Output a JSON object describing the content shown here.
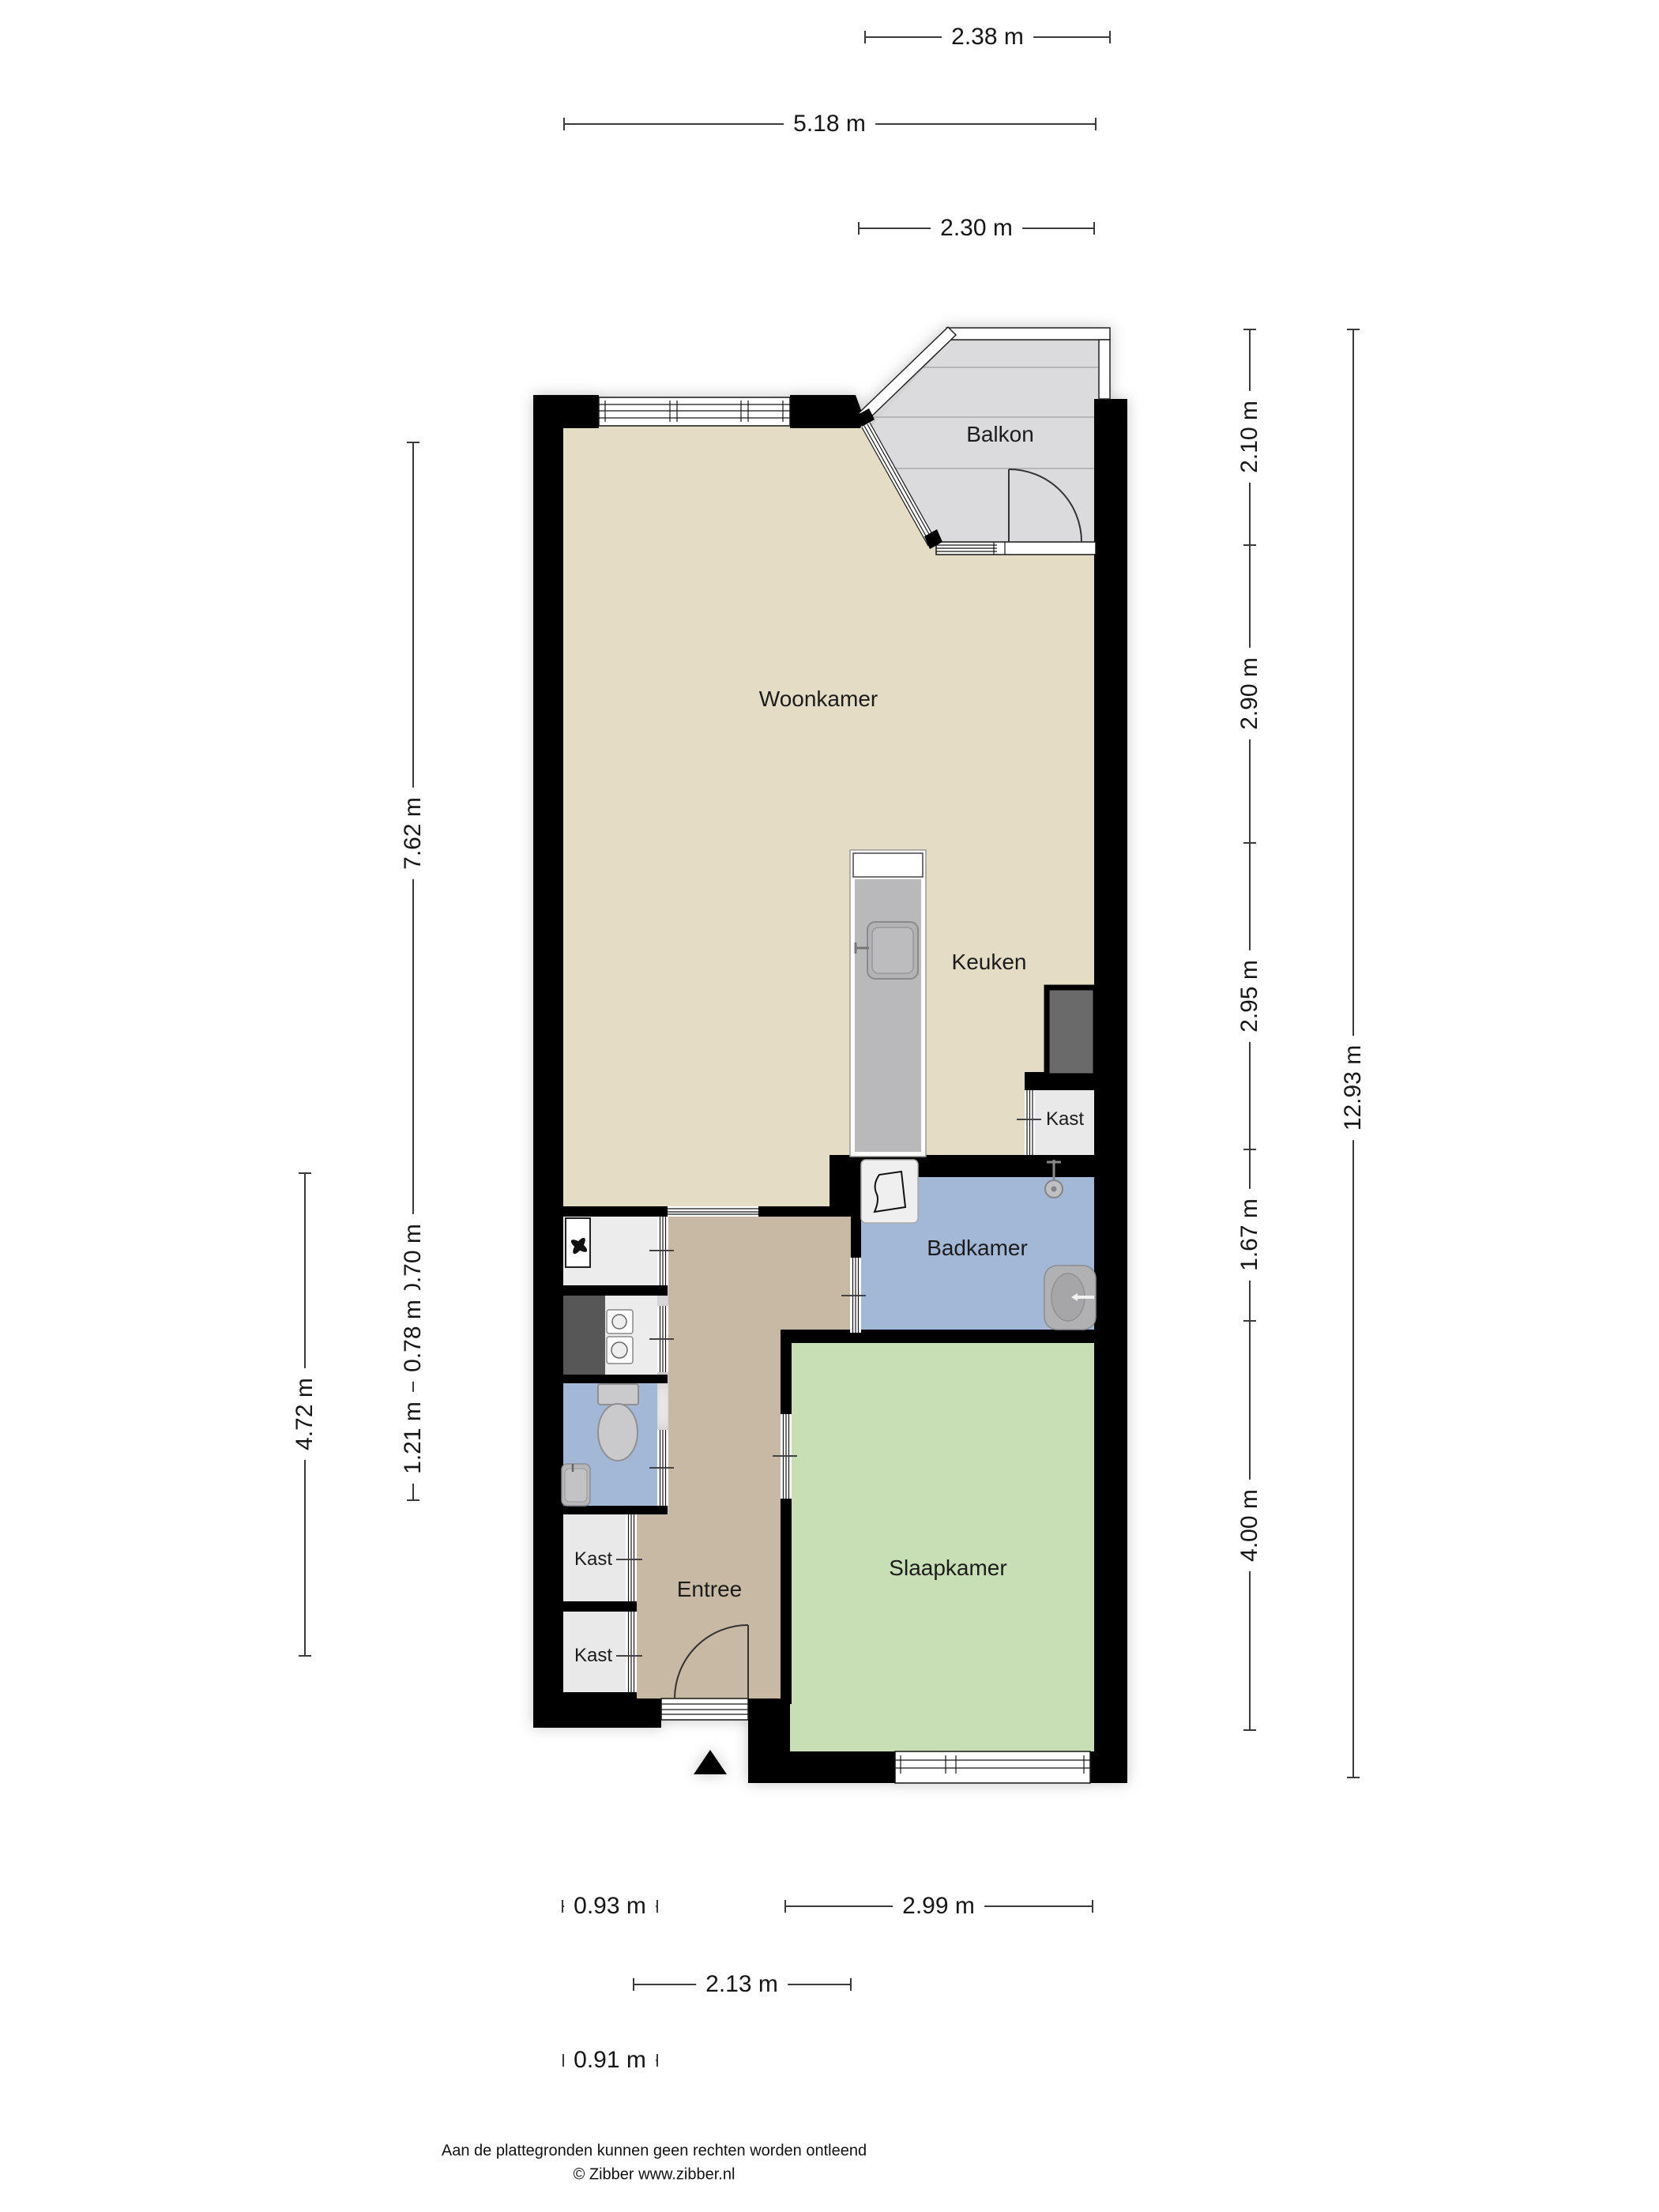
{
  "rooms": {
    "woonkamer": {
      "label": "Woonkamer"
    },
    "keuken": {
      "label": "Keuken"
    },
    "balkon": {
      "label": "Balkon"
    },
    "badkamer": {
      "label": "Badkamer"
    },
    "slaapkamer": {
      "label": "Slaapkamer"
    },
    "entree": {
      "label": "Entree"
    },
    "kast_keuken": {
      "label": "Kast"
    },
    "kast_hal_1": {
      "label": "Kast"
    },
    "kast_hal_2": {
      "label": "Kast"
    }
  },
  "dimensions": {
    "top": [
      "2.38 m",
      "5.18 m",
      "2.30 m"
    ],
    "right_inner": [
      "2.10 m",
      "2.90 m",
      "2.95 m",
      "1.67 m",
      "4.00 m"
    ],
    "right_outer": [
      "12.93 m"
    ],
    "left_inner": [
      "7.62 m",
      "0.70 m",
      "0.78 m",
      "1.21 m"
    ],
    "left_outer": [
      "4.72 m"
    ],
    "bottom": [
      "0.93 m",
      "2.99 m",
      "2.13 m",
      "0.91 m"
    ]
  },
  "footer": {
    "disclaimer": "Aan de plattegronden kunnen geen rechten worden ontleend",
    "copyright": "© Zibber www.zibber.nl"
  },
  "icons": [
    "entrance-arrow-icon",
    "door-swing-icon",
    "window-icon",
    "fan-icon",
    "boiler-icon",
    "toilet-icon",
    "sink-icon",
    "washbasin-icon",
    "shower-icon",
    "washer-icon",
    "kitchen-sink-icon",
    "fridge-icon"
  ],
  "colors": {
    "wall": "#000000",
    "living": "#e4dcc4",
    "entree": "#c8b9a4",
    "bedroom": "#c8dfb6",
    "bath": "#a3b7d6",
    "closet": "#e9e9e9",
    "balcony": "#dbdbdd"
  }
}
